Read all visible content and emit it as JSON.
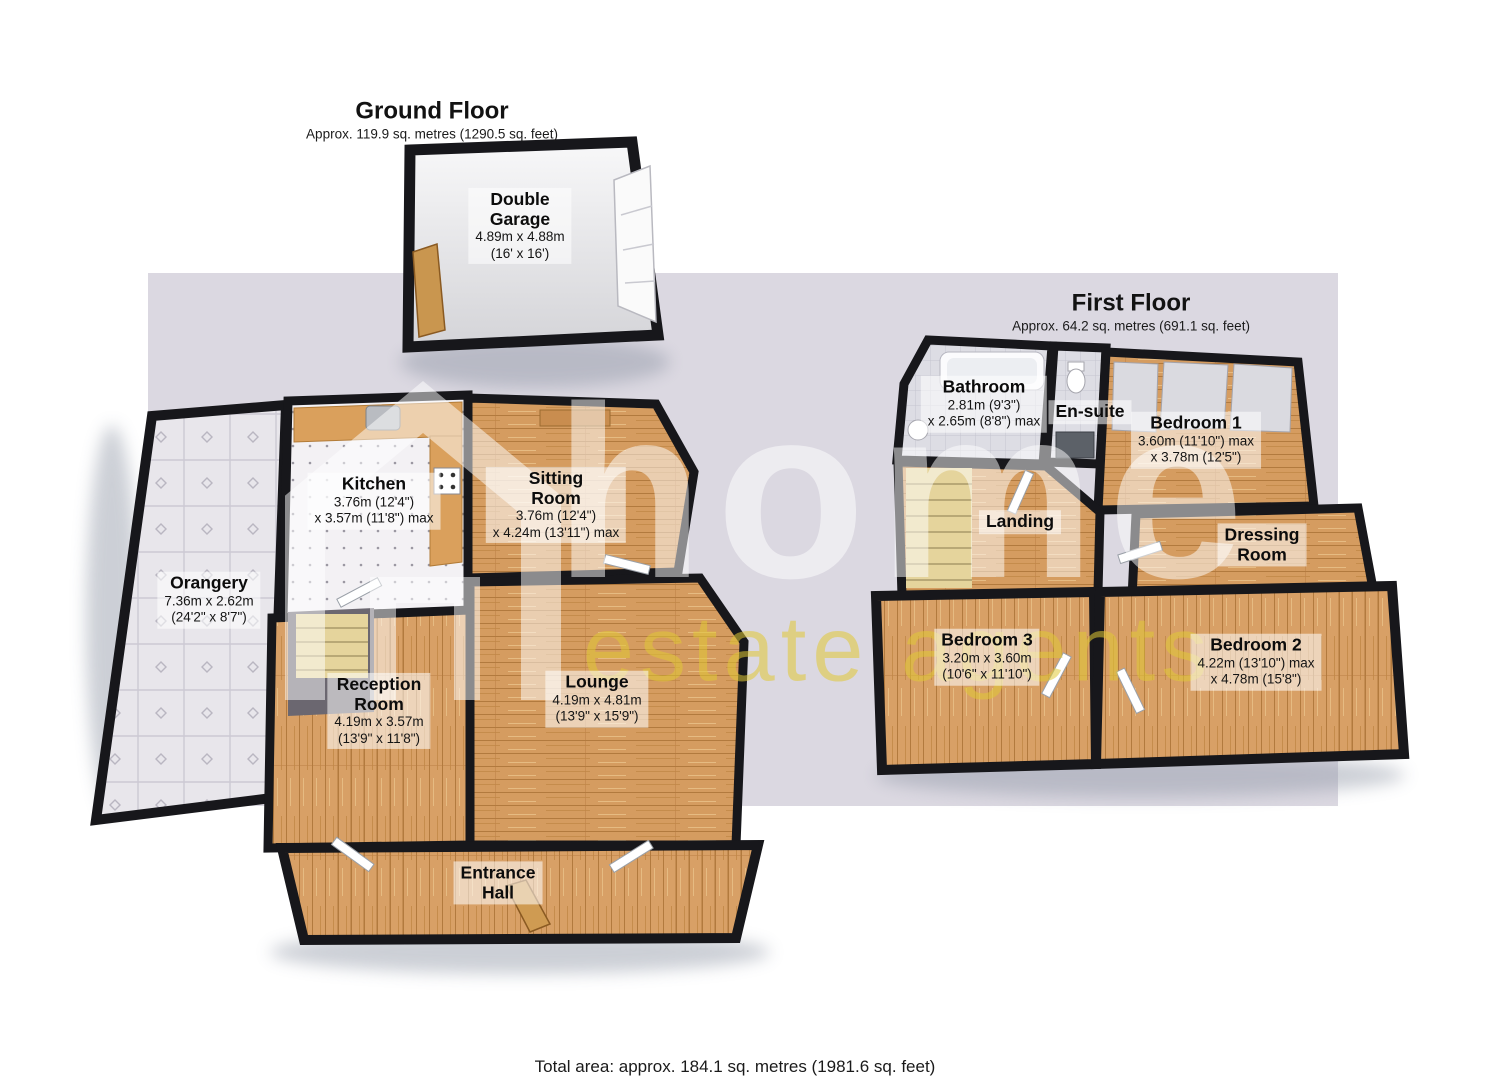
{
  "page": {
    "background": "#ffffff",
    "plan_backdrop_color": "#dbd8e1",
    "total_area_label": "Total area: approx. 184.1 sq. metres (1981.6 sq. feet)"
  },
  "watermark": {
    "brand": "home",
    "tagline": "estate agents",
    "brand_color": "#ffffff",
    "tagline_color": "#e0c834",
    "icon": "house-outline-icon"
  },
  "palette": {
    "walls": "#17171b",
    "wood_floor": "#d59c60",
    "orangery_tile": "#e8e6eb",
    "kitchen_floor": "#f3f1f4",
    "bathroom_tile": "#dddde4",
    "garage_floor": "#e3e3e6",
    "label_chip": "rgba(255,255,255,0.55)"
  },
  "floors": {
    "ground": {
      "title": "Ground Floor",
      "area": "Approx. 119.9 sq. metres (1290.5 sq. feet)",
      "rooms": {
        "garage": {
          "name": "Double\nGarage",
          "dims": [
            "4.89m x 4.88m",
            "(16' x 16')"
          ]
        },
        "kitchen": {
          "name": "Kitchen",
          "dims": [
            "3.76m (12'4\")",
            "x 3.57m (11'8\") max"
          ]
        },
        "sitting": {
          "name": "Sitting\nRoom",
          "dims": [
            "3.76m (12'4\")",
            "x 4.24m (13'11\") max"
          ]
        },
        "orangery": {
          "name": "Orangery",
          "dims": [
            "7.36m x 2.62m",
            "(24'2\" x 8'7\")"
          ]
        },
        "reception": {
          "name": "Reception\nRoom",
          "dims": [
            "4.19m x 3.57m",
            "(13'9\" x 11'8\")"
          ]
        },
        "lounge": {
          "name": "Lounge",
          "dims": [
            "4.19m x 4.81m",
            "(13'9\" x 15'9\")"
          ]
        },
        "entrance": {
          "name": "Entrance\nHall",
          "dims": []
        }
      }
    },
    "first": {
      "title": "First Floor",
      "area": "Approx. 64.2 sq. metres (691.1 sq. feet)",
      "rooms": {
        "bathroom": {
          "name": "Bathroom",
          "dims": [
            "2.81m (9'3\")",
            "x 2.65m (8'8\") max"
          ]
        },
        "ensuite": {
          "name": "En-suite",
          "dims": []
        },
        "bedroom1": {
          "name": "Bedroom 1",
          "dims": [
            "3.60m (11'10\") max",
            "x 3.78m (12'5\")"
          ]
        },
        "landing": {
          "name": "Landing",
          "dims": []
        },
        "dressing": {
          "name": "Dressing\nRoom",
          "dims": []
        },
        "bedroom3": {
          "name": "Bedroom 3",
          "dims": [
            "3.20m x 3.60m",
            "(10'6\" x 11'10\")"
          ]
        },
        "bedroom2": {
          "name": "Bedroom 2",
          "dims": [
            "4.22m (13'10\") max",
            "x 4.78m (15'8\")"
          ]
        }
      }
    }
  }
}
